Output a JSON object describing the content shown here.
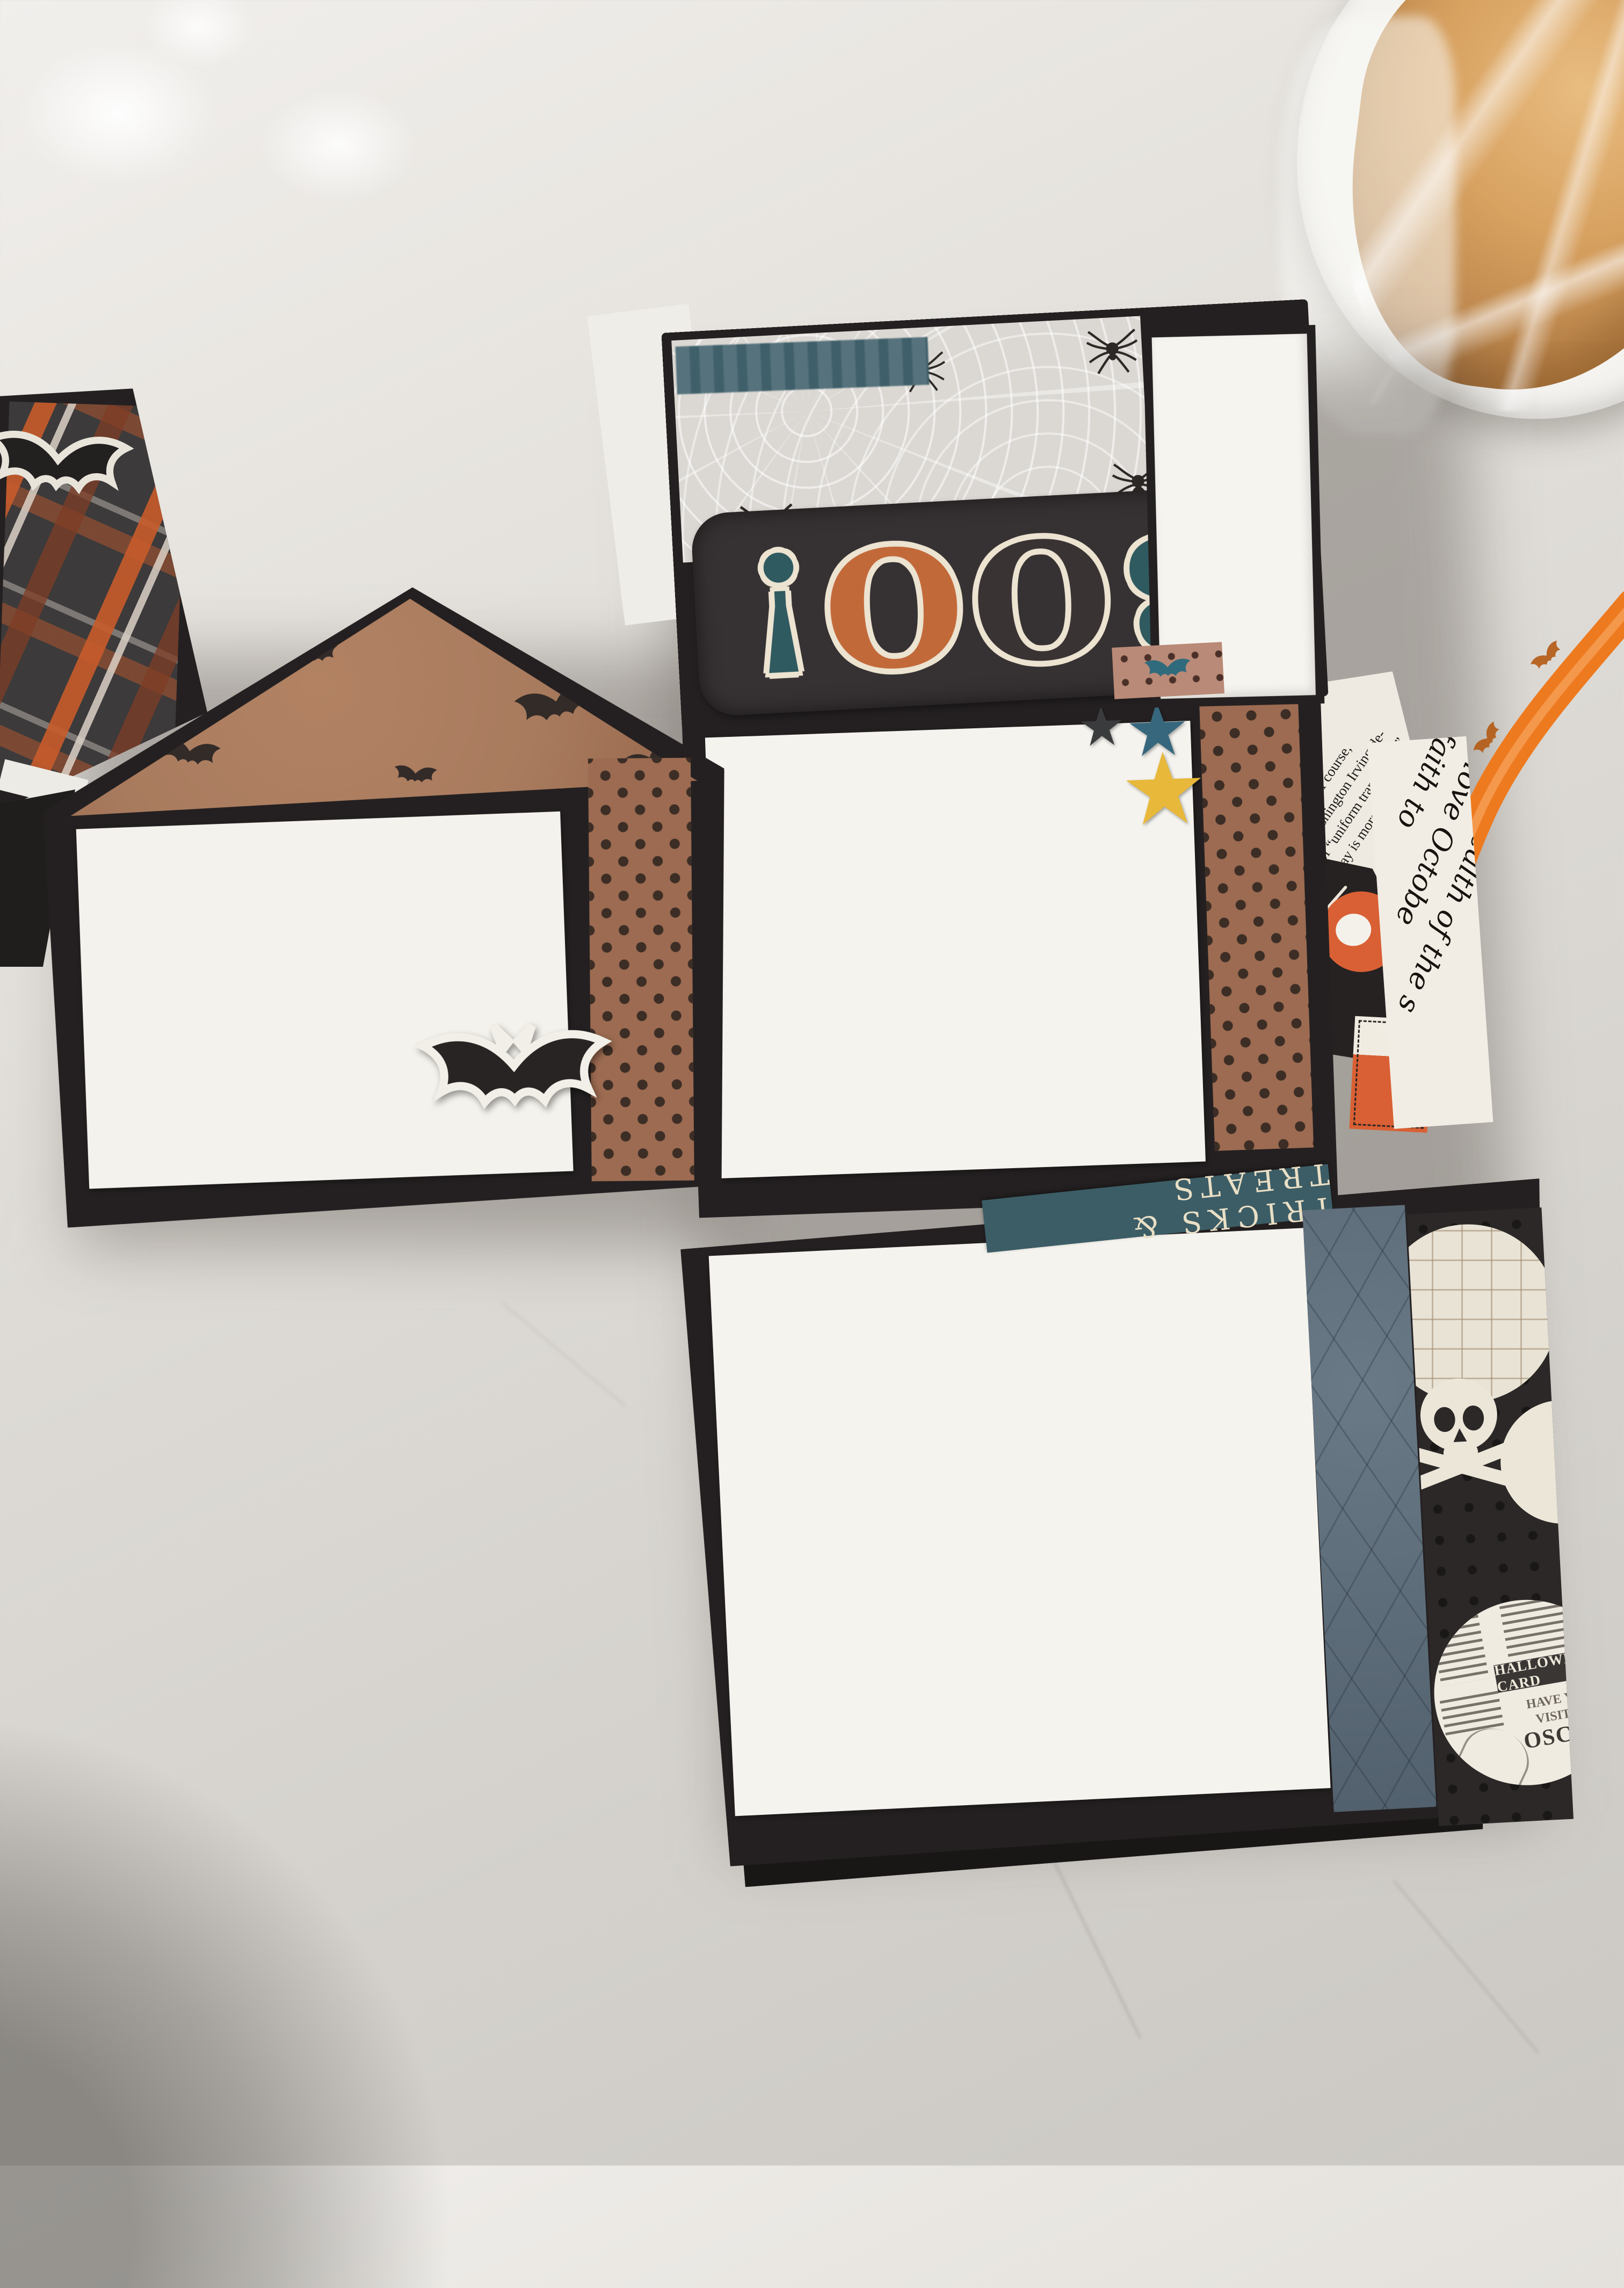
{
  "scene": {
    "description": "Halloween mini scrapbook album opened flat on a white quartz countertop, bread loaf in a plastic bag on a plate, orange bat-print ribbon",
    "colors": {
      "countertop": "#e7e4df",
      "page_black": "#242021",
      "kraft_bat_paper": "#a97b5e",
      "polka_brown": "#9c6b51",
      "mat_white": "#f4f2ec",
      "spiderweb_paper": "#dbd8d3",
      "banner_black": "#363132",
      "teal_strip": "#3f5f6a",
      "navy_argyle": "#5d6e7c",
      "ribbon_orange": "#ee7a1f",
      "accent_orange": "#d96034",
      "cream": "#ece3d1",
      "plaid_orange": "#c75b2a"
    }
  },
  "album": {
    "boo_page": {
      "title_letters": [
        "B",
        "O",
        "O",
        "!"
      ],
      "title_letter_colors": [
        "#2f5a60",
        "#393334",
        "#c2693a",
        "#2f5a60"
      ]
    },
    "stars_page": {
      "newsprint_lines": [
        "famous spot of all is, of course,",
        "Hollow itself. Washington Irving de-",
        "it as a place of “uniform tranquillity.”",
        "Hollow of today is more active",
        "imagination tha"
      ],
      "script_lines": [
        "Where the",
        "the wealth of the s",
        "I love Octobe",
        "faith to"
      ]
    },
    "bottom_page": {
      "strip_label": "TRICKS & TREATS",
      "ad_circle": {
        "headline": "HALLOWEEN CARD",
        "line1": "HAVE YOU",
        "line2": "VISITED",
        "name": "OSCAR"
      }
    }
  }
}
